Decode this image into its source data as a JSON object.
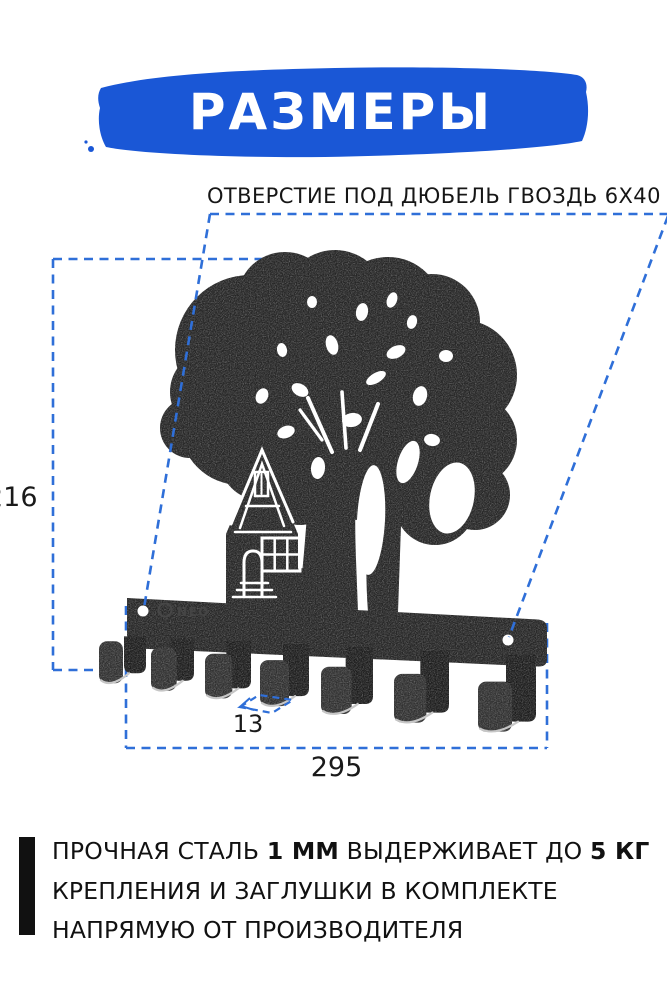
{
  "palette": {
    "banner_blue": "#1a57d6",
    "accent_blue": "#2f6fd8",
    "ink": "#141414",
    "steel_dark": "#262626",
    "hole_white": "#ffffff"
  },
  "banner": {
    "title": "РАЗМЕРЫ"
  },
  "callout": {
    "label": "ОТВЕРСТИЕ ПОД ДЮБЕЛЬ ГВОЗДЬ 6X40"
  },
  "dimensions": {
    "height_mm": "216",
    "width_mm": "295",
    "hook_width_mm": "13"
  },
  "product": {
    "brand_engraving": "NEO",
    "hook_count": 7
  },
  "info": {
    "line1": [
      {
        "text": "ПРОЧНАЯ СТАЛЬ ",
        "bold": false
      },
      {
        "text": "1 ММ",
        "bold": true
      },
      {
        "text": " ВЫДЕРЖИВАЕТ ДО ",
        "bold": false
      },
      {
        "text": "5 КГ",
        "bold": true
      }
    ],
    "line2": "КРЕПЛЕНИЯ И ЗАГЛУШКИ В КОМПЛЕКТЕ",
    "line3": "НАПРЯМУЮ ОТ ПРОИЗВОДИТЕЛЯ"
  }
}
